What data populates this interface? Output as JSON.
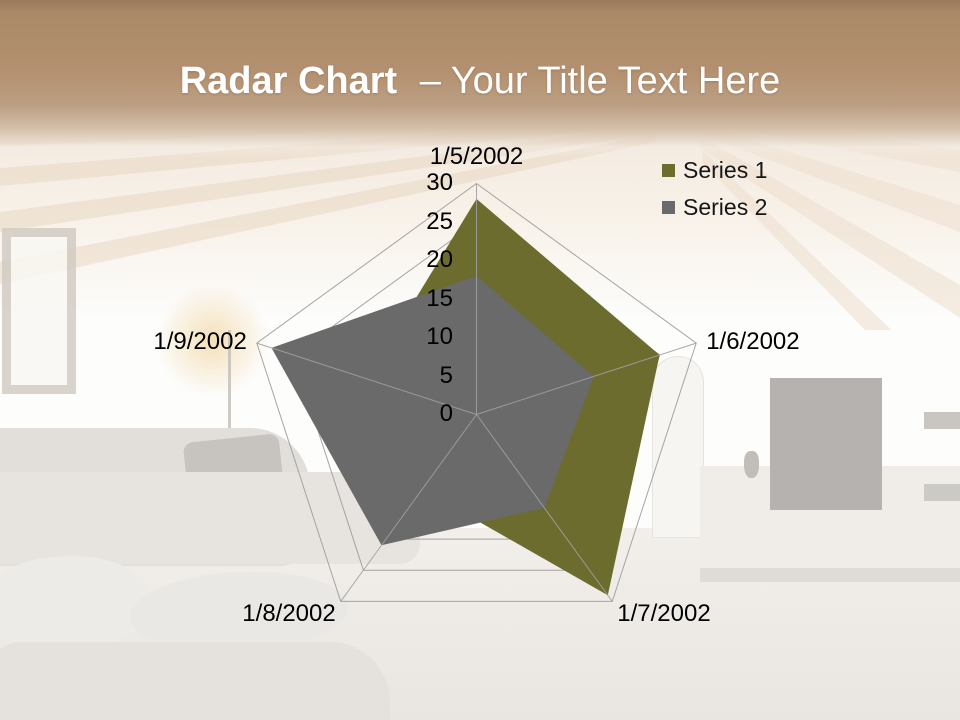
{
  "slide": {
    "title": {
      "bold": "Radar Chart",
      "regular": "– Your Title Text Here"
    },
    "accent_band_top_color": "#997a5a",
    "accent_band_mid_color": "#b39170",
    "title_text_color": "#ffffff"
  },
  "chart_data": {
    "type": "radar",
    "categories": [
      "1/5/2002",
      "1/6/2002",
      "1/7/2002",
      "1/8/2002",
      "1/9/2002"
    ],
    "series": [
      {
        "name": "Series 1",
        "color": "#6B6C2E",
        "values": [
          28,
          25,
          29,
          12,
          15
        ]
      },
      {
        "name": "Series 2",
        "color": "#6A6A6A",
        "values": [
          18,
          16,
          15,
          21,
          28
        ]
      }
    ],
    "r_axis": {
      "min": 0,
      "max": 30,
      "step": 5,
      "tick_labels": [
        "0",
        "5",
        "10",
        "15",
        "20",
        "25",
        "30"
      ]
    },
    "grid": true,
    "legend_position": "top-right",
    "gridline_color": "#9B9B9B",
    "spoke_color": "#A0A0A0",
    "label_text_color": "#000000"
  }
}
